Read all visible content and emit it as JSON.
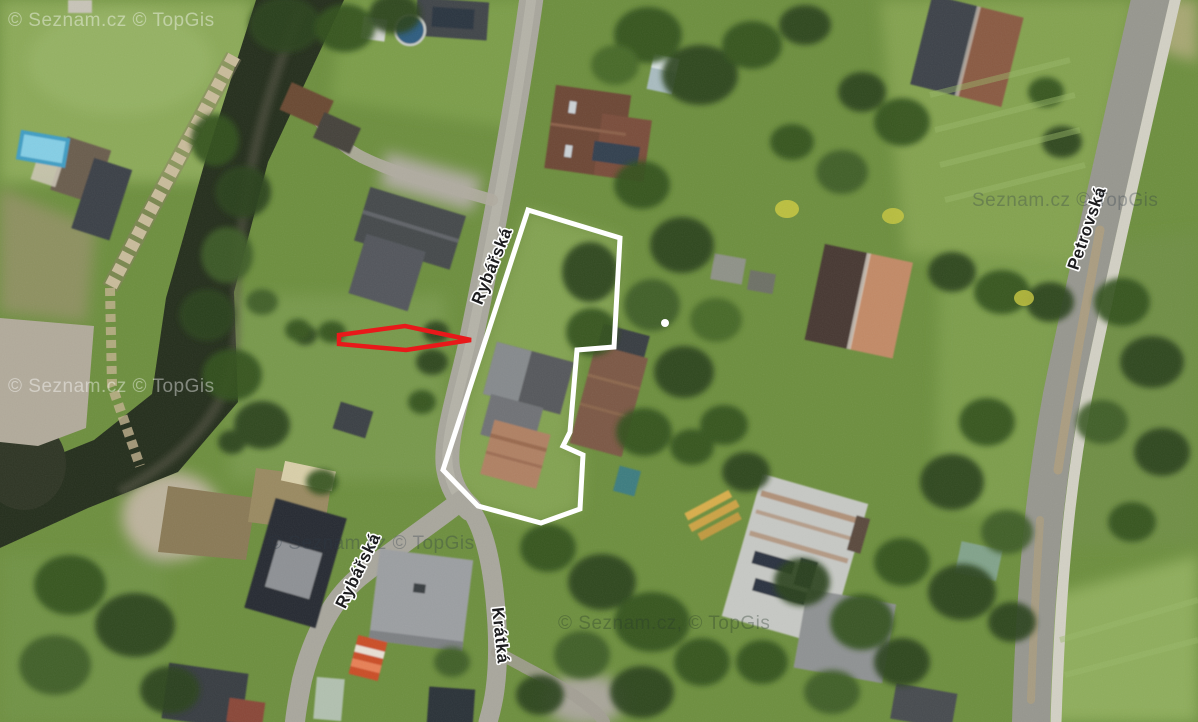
{
  "map": {
    "streets": {
      "rybarska_north": "Rybářská",
      "rybarska_south": "Rybářská",
      "kratka": "Krátká",
      "petrovska": "Petrovská"
    },
    "watermarks": {
      "top_left": "© Seznam.cz © TopGis",
      "mid_left": "© Seznam.cz © TopGis",
      "lower_left": "© Seznam.cz © TopGis",
      "bottom_center": "© Seznam.cz, © TopGis",
      "right": "Seznam.cz © TopGis"
    },
    "annotations": {
      "parcel_outline_color": "#ffffff",
      "arrow_color": "#e8191a",
      "marker_color": "#ffffff"
    }
  }
}
